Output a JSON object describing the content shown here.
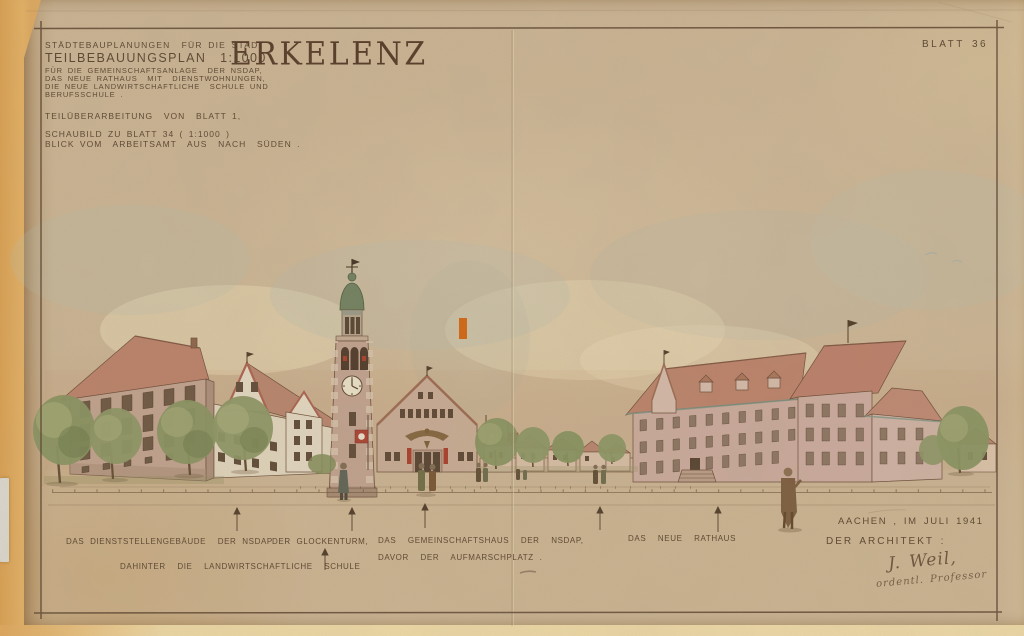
{
  "document": {
    "kind": "scanned architectural presentation drawing, Erkelenz town planning, 1941",
    "sheet_number": "BLATT 36"
  },
  "title_block": {
    "line1": "STÄDTEBAUPLANUNGEN  FÜR DIE STADT",
    "city": "ERKELENZ",
    "line2": "TEILBEBAUUNGSPLAN  1:1000",
    "line3": "FÜR DIE GEMEINSCHAFTSANLAGE  DER NSDAP,",
    "line4": "DAS NEUE RATHAUS  MIT  DIENSTWOHNUNGEN,",
    "line5": "DIE NEUE LANDWIRTSCHAFTLICHE  SCHULE UND",
    "line6": "BERUFSSCHULE .",
    "revision_note": "TEILÜBERARBEITUNG  VON  BLATT 1,",
    "view_note_line1": "SCHAUBILD ZU BLATT 34 ( 1:1000 )",
    "view_note_line2": "BLICK VOM  ARBEITSAMT  AUS  NACH  SÜDEN ."
  },
  "captions": {
    "office_building": "DAS DIENSTSTELLENGEBÄUDE  DER NSDAP",
    "office_building_sub": "DAHINTER  DIE  LANDWIRTSCHAFTLICHE  SCHULE",
    "bell_tower": "DER GLOCKENTURM,",
    "community_hall_line1": "DAS  GEMEINSCHAFTSHAUS  DER  NSDAP,",
    "community_hall_line2": "DAVOR  DER  AUFMARSCHPLATZ .",
    "town_hall": "DAS  NEUE  RATHAUS"
  },
  "signature_block": {
    "place_date": "AACHEN , IM JULI 1941",
    "architect_label": "DER ARCHITEKT :",
    "signature": "J. Weil,",
    "signature_title": "ordentl. Professor"
  },
  "colors": {
    "paper": "#c8b292",
    "margin_orange": "#d9a45f",
    "ink_brown": "#4e3a26",
    "roof_red": "#b97f68",
    "wall_pink": "#c2a38f",
    "cream_wall": "#ded2ba",
    "tree_green": "#86905e",
    "dome_green": "#6e7e5e",
    "flag_red": "#a84030",
    "accent_mark": "#d06410"
  }
}
